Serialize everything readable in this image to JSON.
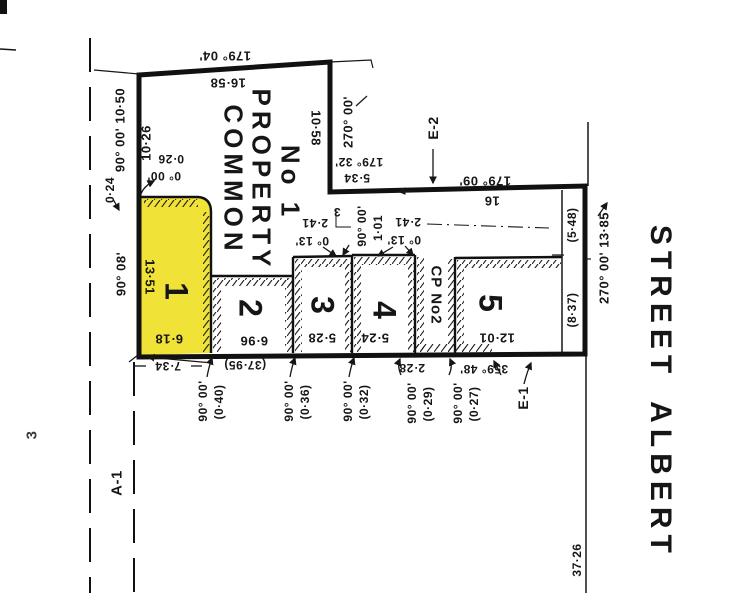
{
  "streets": {
    "albert": "ALBERT",
    "street_word": "STREET",
    "south_frontage": "37·26"
  },
  "common_property_1": {
    "word1": "COMMON",
    "word2": "PROPERTY",
    "word3": "No 1"
  },
  "lots": {
    "lot1": {
      "num": "1",
      "depth": "13·51",
      "width": "6·18"
    },
    "lot2": {
      "num": "2",
      "width": "6·96"
    },
    "lot3": {
      "num": "3",
      "width": "5·28"
    },
    "lot4": {
      "num": "4",
      "width": "5·24"
    },
    "lot5": {
      "num": "5",
      "width": "12·01",
      "frontage": "(8·37)"
    },
    "cp2": {
      "label": "CP No2",
      "width": "2·28"
    }
  },
  "easements": {
    "e1": "E-1",
    "e2": "E-2",
    "a1": "A-1",
    "left_mark": "3"
  },
  "boundaries": {
    "north": {
      "bearing": "179° 04'",
      "distance": "16·58"
    },
    "west_upper": {
      "bearing_distance": "90° 00' 10·50",
      "inner": "10·26",
      "offset_a": "0·24",
      "offset_b": "0·26",
      "offset_bearing": "0° 00'"
    },
    "west_lot1": {
      "bearing": "90° 08'"
    },
    "east_upper": {
      "bearing": "270° 00'",
      "distance": "10·58"
    },
    "mid_west": {
      "bearing": "179° 32'",
      "distance": "5·34"
    },
    "mid_east": {
      "bearing": "179° 09'",
      "distance": "16"
    },
    "street": {
      "bearing_distance": "270° 00' 13·85",
      "seg_north": "(5·48)"
    },
    "south": {
      "bearing": "359° 48'",
      "overall": "(37·95)",
      "left": "7·34"
    },
    "steps": {
      "bearing": "90° 00'",
      "distance": "1·01",
      "small": "3",
      "jog_w_dist": "2·41",
      "jog_w_bearing": "0° 13'",
      "jog_e_dist": "2·41",
      "jog_e_bearing": "0° 13'"
    },
    "south_jogs": [
      {
        "bearing": "90° 00'",
        "offset": "(0·40)"
      },
      {
        "bearing": "90° 00'",
        "offset": "(0·36)"
      },
      {
        "bearing": "90° 00'",
        "offset": "(0·32)"
      },
      {
        "bearing": "90° 00'",
        "offset": "(0·29)"
      },
      {
        "bearing": "90° 00'",
        "offset": "(0·27)"
      }
    ]
  },
  "colors": {
    "lot1_fill": "#f0e236",
    "ink": "#161616"
  }
}
